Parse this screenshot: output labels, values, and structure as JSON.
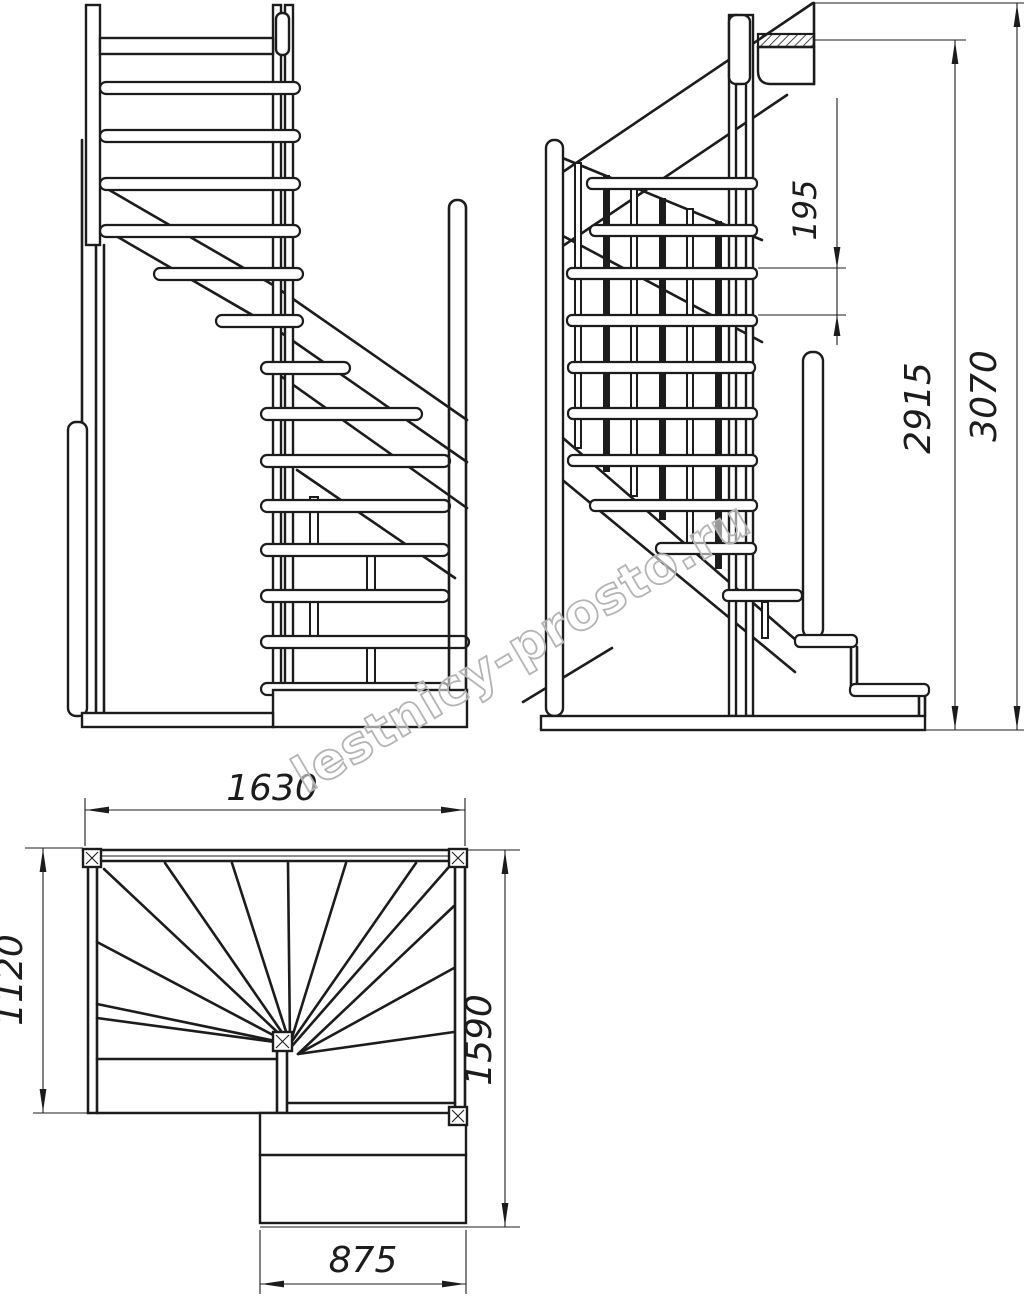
{
  "watermark": {
    "text": "lestnicy-prosto.ru"
  },
  "colors": {
    "line": "#1c1c1c",
    "watermark_outline": "#b4b4b4",
    "background": "#ffffff"
  },
  "plan_view": {
    "overall_width": "1630",
    "left_depth": "1120",
    "right_depth": "1590",
    "lower_flight_width": "875"
  },
  "side_view": {
    "riser_height": "195",
    "floor_to_landing": "2915",
    "total_height": "3070"
  }
}
